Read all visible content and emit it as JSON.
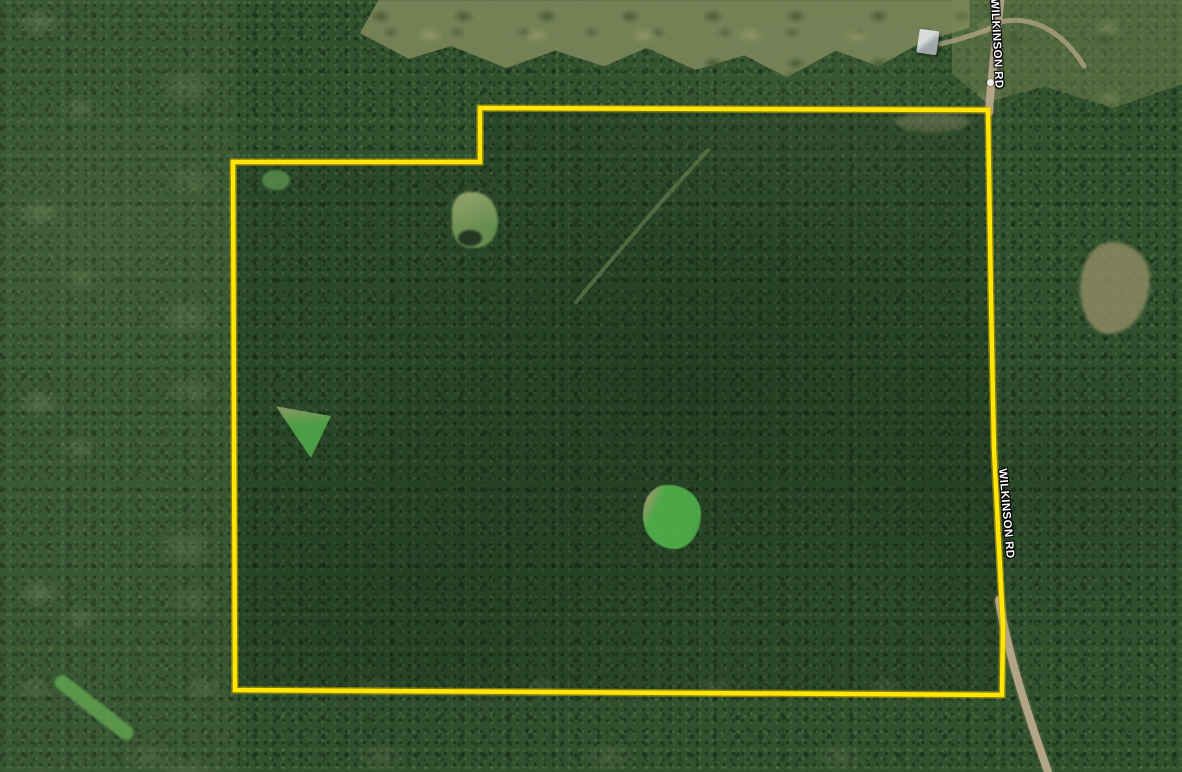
{
  "window": {
    "width": 1182,
    "height": 772
  },
  "map": {
    "description": "Satellite aerial view of a wooded land parcel outlined in yellow along Wilkinson Rd",
    "road_labels": [
      {
        "text": "WILKINSON RD",
        "position": "top-right-vertical",
        "rotation_deg": 87
      },
      {
        "text": "WILKINSON RD",
        "position": "right-middle-along-road",
        "rotation_deg": 85
      }
    ],
    "parcel_boundary": {
      "stroke_color": "#ffe606",
      "halo_color": "#c9a606",
      "stroke_width": 4.5,
      "points": "233,162 480,162 480,108 988,110 991,300 994,450 1003,625 1002,695 235,690"
    },
    "road": {
      "name": "Wilkinson Rd",
      "surface": "dirt",
      "color": "#b7aa8c"
    },
    "colors": {
      "forest_dark": "#2b4629",
      "forest_base": "#31512e",
      "forest_left_light": "#4c6a45",
      "cutover_olive": "#7b865a",
      "field_bright_green": "#4fae49",
      "clearing_tan": "#8d8a62",
      "pond_dark": "#1c2f1e",
      "dirt_road": "#b7aa8c",
      "boundary_yellow": "#ffe606"
    },
    "features": [
      "dense-forest-canopy",
      "cutover-clearing-top",
      "light-forest-left",
      "small-clearing-top-left",
      "clearing-with-pond-near-notch",
      "triangular-field-left",
      "green-field-center",
      "green-strip-bottom-left",
      "tan-clearing-right",
      "house-top-right",
      "dirt-road-wilkinson",
      "interior-trail"
    ]
  }
}
